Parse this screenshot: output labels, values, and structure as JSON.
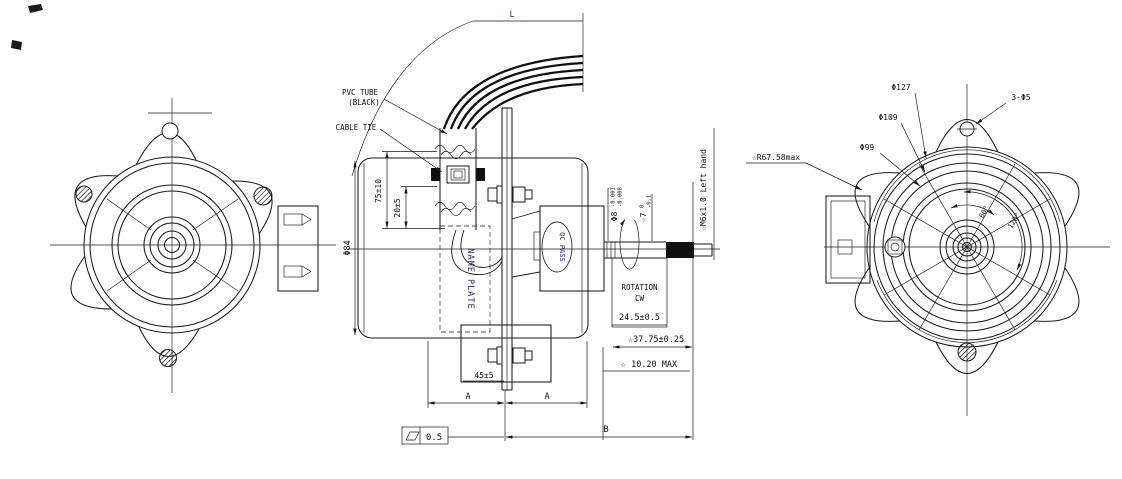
{
  "colors": {
    "background": "#ffffff",
    "line": "#1a1a1a",
    "stamp_navy": "#262678",
    "dim_blue": "#2230c8"
  },
  "middle_view": {
    "lead_length_label": "L",
    "pvc_tube_label_1": "PVC TUBE",
    "pvc_tube_label_2": "(BLACK)",
    "cable_tie_label": "CABLE TIE",
    "dim_tube_free": "75±10",
    "dim_tube_clamp": "20±5",
    "dim_body_dia": "Φ84",
    "name_plate_label": "NAME PLATE",
    "qc_pass_stamp": "QC PASS",
    "dim_foot": "45±5",
    "section_label_left": "A",
    "section_label_right": "A",
    "dim_overall": "B",
    "flatness_tolerance": "0.5",
    "rotation_label_1": "ROTATION",
    "rotation_label_2": "CW",
    "dim_shaft_ext": "24.5±0.5",
    "dim_shaft_total": "☆37.75±0.25",
    "dim_boss_max": "☆ 10.20 MAX",
    "shaft_dia": "Φ8",
    "shaft_dia_tol_upper": "-0.001",
    "shaft_dia_tol_lower": "-0.008",
    "shaft_flat": "☆7",
    "shaft_flat_tol_upper": "0",
    "shaft_flat_tol_lower": "-0.1",
    "thread_note": "☆M6x1.0 Left hand"
  },
  "right_view": {
    "dim_dia_127": "Φ127",
    "dim_dia_109": "Φ109",
    "dim_dia_99": "Φ99",
    "mount_holes": "3-Φ5",
    "radius_note": "☆R67.58max",
    "angle_60": "60°",
    "angle_120": "120°"
  }
}
